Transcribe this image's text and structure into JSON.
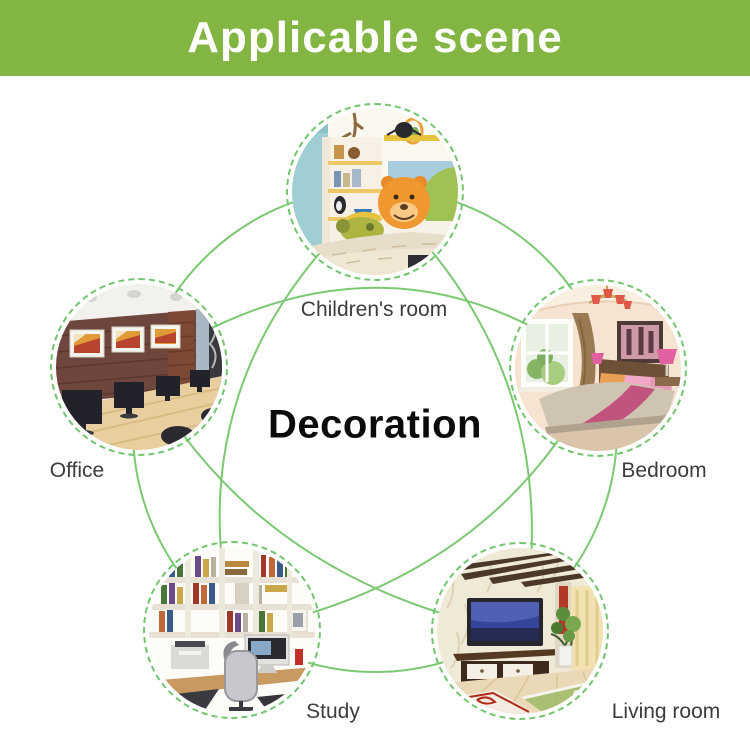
{
  "banner": {
    "title": "Applicable scene",
    "bg_color": "#82b541",
    "text_color": "#ffffff"
  },
  "center_label": "Decoration",
  "theme": {
    "curve_color": "#7cc873",
    "dashed_border_color": "#72c56e",
    "label_color": "#3c3c3c"
  },
  "scenes": [
    {
      "label": "Children's room"
    },
    {
      "label": "Bedroom"
    },
    {
      "label": "Living room"
    },
    {
      "label": "Study"
    },
    {
      "label": "Office"
    }
  ]
}
